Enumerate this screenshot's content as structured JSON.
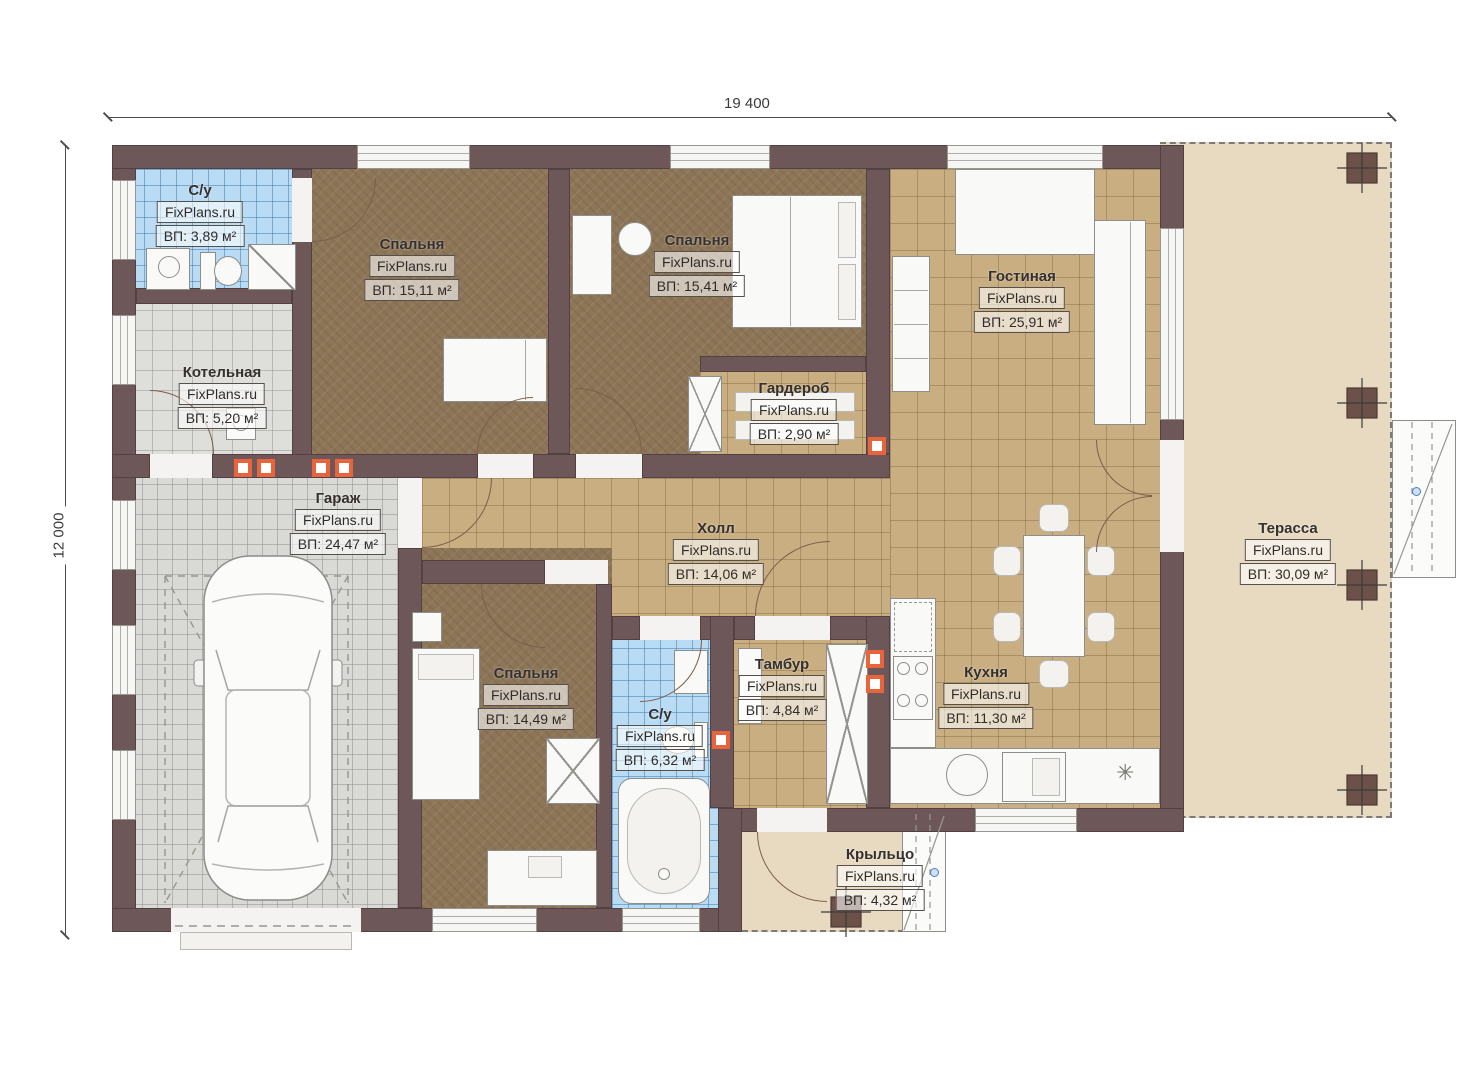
{
  "watermark": "FixPlans.ru",
  "dimensions": {
    "width": "19 400",
    "height": "12 000"
  },
  "rooms": [
    {
      "key": "su_top",
      "name": "С/у",
      "area": "ВП: 3,89 м²"
    },
    {
      "key": "bedroom_1",
      "name": "Спальня",
      "area": "ВП: 15,11 м²"
    },
    {
      "key": "bedroom_2",
      "name": "Спальня",
      "area": "ВП: 15,41 м²"
    },
    {
      "key": "living",
      "name": "Гостиная",
      "area": "ВП: 25,91 м²"
    },
    {
      "key": "boiler",
      "name": "Котельная",
      "area": "ВП: 5,20 м²"
    },
    {
      "key": "wardrobe",
      "name": "Гардероб",
      "area": "ВП: 2,90 м²"
    },
    {
      "key": "garage",
      "name": "Гараж",
      "area": "ВП: 24,47 м²"
    },
    {
      "key": "hall",
      "name": "Холл",
      "area": "ВП: 14,06 м²"
    },
    {
      "key": "terrace",
      "name": "Терасса",
      "area": "ВП: 30,09 м²"
    },
    {
      "key": "bedroom_3",
      "name": "Спальня",
      "area": "ВП: 14,49 м²"
    },
    {
      "key": "su_bottom",
      "name": "С/у",
      "area": "ВП: 6,32 м²"
    },
    {
      "key": "tambour",
      "name": "Тамбур",
      "area": "ВП: 4,84 м²"
    },
    {
      "key": "kitchen",
      "name": "Кухня",
      "area": "ВП: 11,30 м²"
    },
    {
      "key": "porch",
      "name": "Крыльцо",
      "area": "ВП: 4,32 м²"
    }
  ],
  "symbols": {
    "snowflake": "✳"
  },
  "colors": {
    "wall": "#6d5759",
    "bedroom_floor": "#8d7557",
    "tile_floor": "#c8ae81",
    "bath_floor": "#b9dcf4",
    "garage_floor": "#d9d9d6",
    "terrace_floor": "#e7dac1",
    "vent": "#e8643c"
  }
}
